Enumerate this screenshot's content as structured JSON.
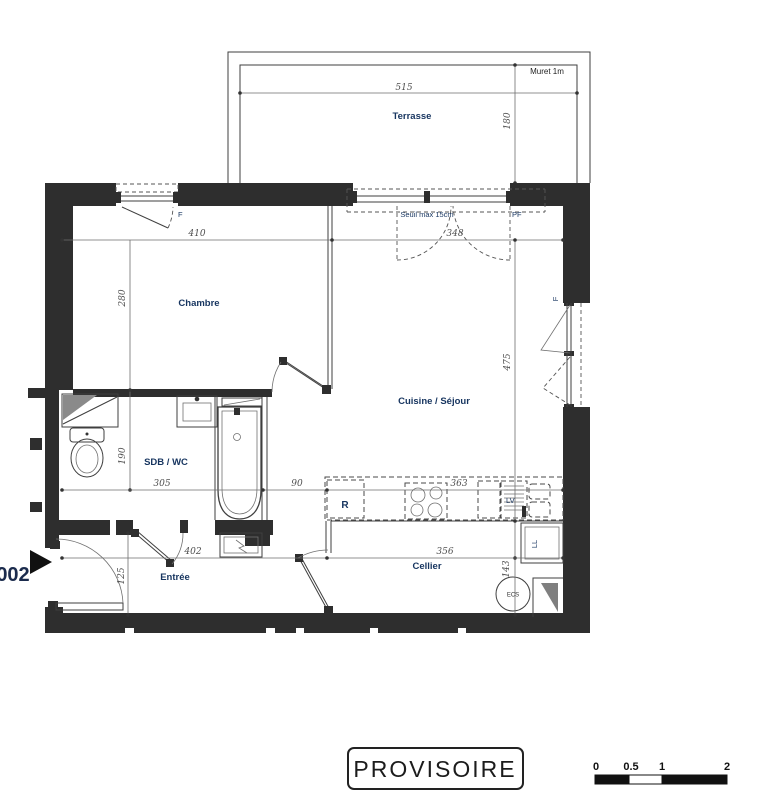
{
  "unit_marker": {
    "number": "002"
  },
  "terrace": {
    "name": "Terrasse",
    "muret_note": "Muret 1m",
    "width": "515",
    "depth": "180"
  },
  "rooms": {
    "chambre": {
      "name": "Chambre",
      "width": "410",
      "height": "280",
      "window_label": "F"
    },
    "cuisine_sejour": {
      "name": "Cuisine / Séjour",
      "width": "348",
      "height": "475",
      "counter_width": "363",
      "threshold_note": "Seuil max 15cm",
      "french_door_label": "PF",
      "side_window_label": "F",
      "fridge_label": "R",
      "dishwasher_label": "LV"
    },
    "sdb_wc": {
      "name": "SDB / WC",
      "width": "305",
      "depth": "190",
      "passage": "90"
    },
    "entree": {
      "name": "Entrée",
      "width": "402",
      "depth": "125"
    },
    "cellier": {
      "name": "Cellier",
      "width": "356",
      "depth": "143",
      "water_heater_label": "ECS",
      "washing_machine_label": "LL"
    }
  },
  "footer": {
    "stamp": "PROVISOIRE",
    "scale_bar": {
      "tick_0": "0",
      "tick_05": "0.5",
      "tick_1": "1",
      "tick_2": "2"
    }
  },
  "colors": {
    "wall": "#2e2e2e",
    "room_label": "#16345f",
    "dimension": "#4f4f4f",
    "line": "#3f3f3f"
  }
}
